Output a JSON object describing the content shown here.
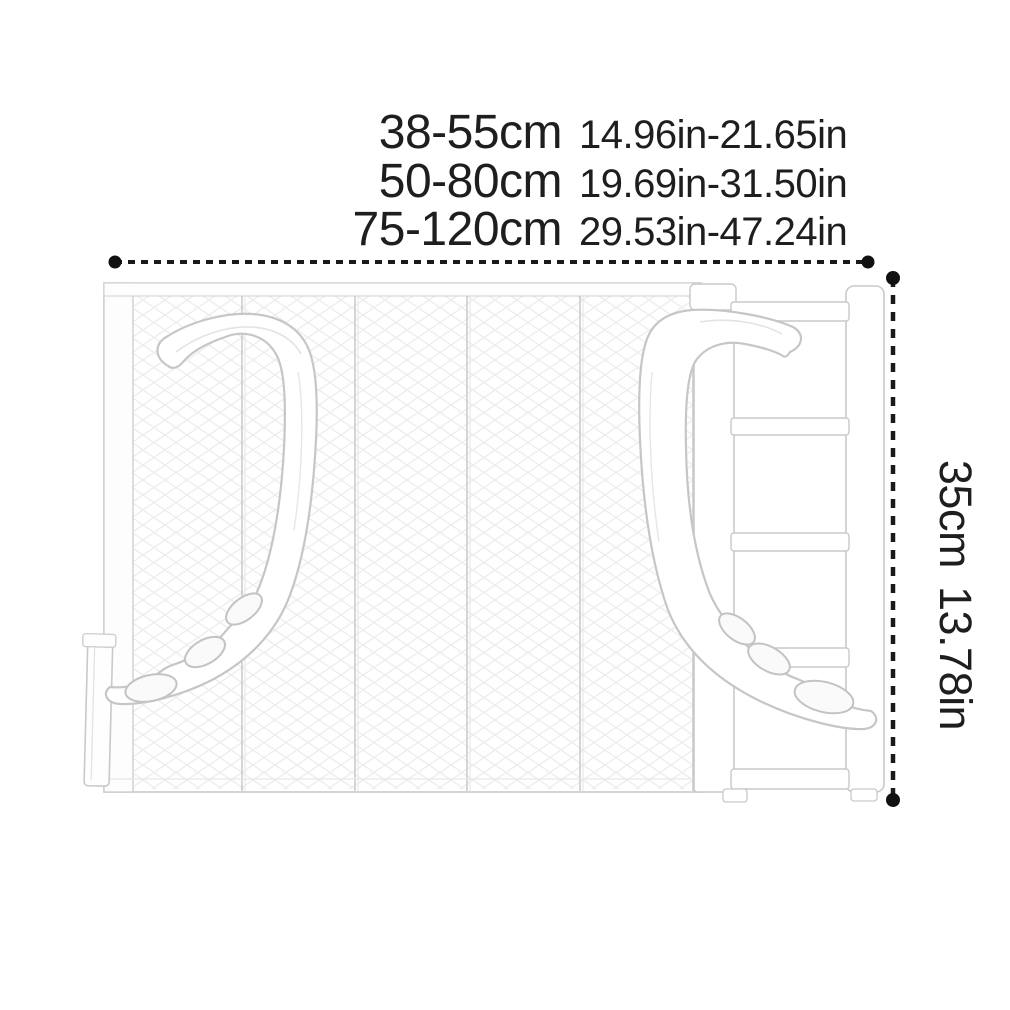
{
  "dimensions": {
    "width_options": [
      {
        "cm": "38-55cm",
        "inches": "14.96in-21.65in"
      },
      {
        "cm": "50-80cm",
        "inches": "19.69in-31.50in"
      },
      {
        "cm": "75-120cm",
        "inches": "29.53in-47.24in"
      }
    ],
    "height": {
      "cm": "35cm",
      "inches": "13.78in"
    }
  },
  "colors": {
    "text": "#1e1e1e",
    "dimension_line": "#1a1a1a",
    "dimension_dot": "#111111",
    "product_outline": "#c7c7c7",
    "product_texture": "#ececec",
    "background": "#ffffff"
  }
}
